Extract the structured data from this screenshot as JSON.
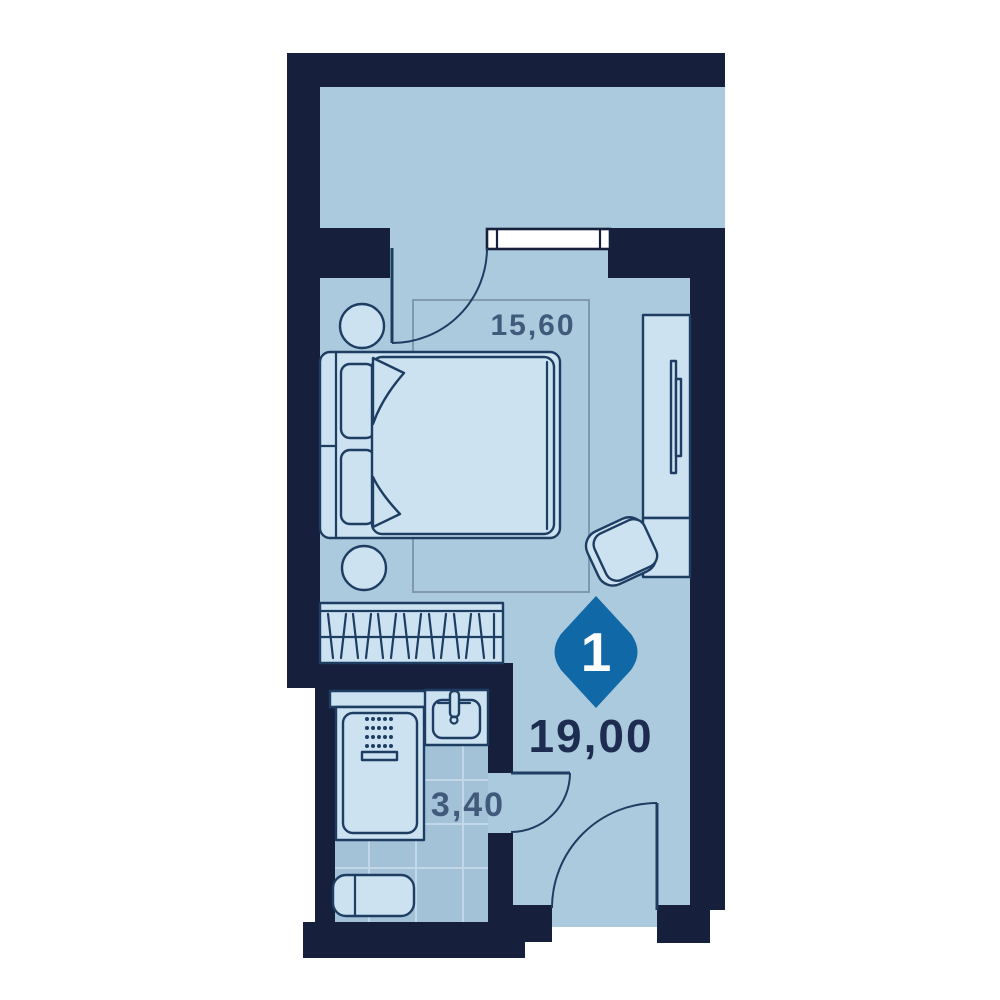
{
  "plan": {
    "unit_badge": {
      "number": "1"
    },
    "total_area_label": "19,00",
    "rooms": [
      {
        "name": "living-bedroom",
        "area_label": "15,60"
      },
      {
        "name": "bathroom",
        "area_label": "3,40"
      }
    ]
  },
  "palette": {
    "wall": "#16203c",
    "floor": "#abcadd",
    "furniture": "#cce2f1",
    "outline": "#1e3d63",
    "tile": "#a3c2d8",
    "tile_line": "#c2d8e8",
    "badge": "#1168a7",
    "area_text": "#41597b",
    "total_text": "#1d2c50",
    "measure_box": "#8099ad",
    "window_fill": "#ffffff",
    "page_bg": "#ffffff"
  }
}
